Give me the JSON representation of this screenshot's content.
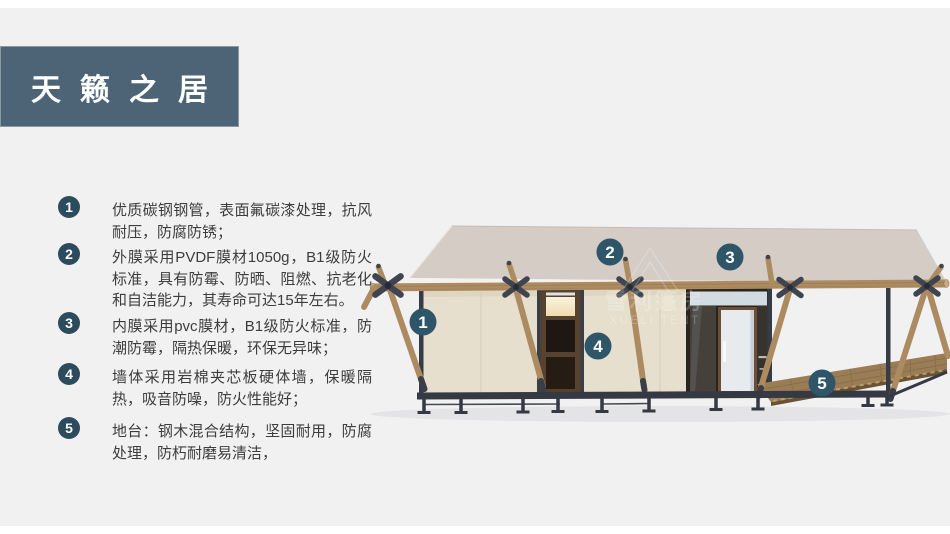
{
  "colors": {
    "page_bg": "#f1f1f2",
    "banner": "#4d6376",
    "badge": "#2c4c5e",
    "callout": "#2e5568",
    "text": "#3d3d3d",
    "roof": "#d5ccc6",
    "wall": "#e7dfcd",
    "wood": "#ad8b61",
    "metal": "#363c45",
    "deck": "#9a7c55"
  },
  "title": {
    "text": "天籁之居"
  },
  "features": [
    {
      "num": "1",
      "text": "优质碳钢钢管，表面氟碳漆处理，抗风耐压，防腐防锈；"
    },
    {
      "num": "2",
      "text": "外膜采用PVDF膜材1050g，B1级防火标准，具有防霉、防晒、阻燃、抗老化和自洁能力，其寿命可达15年左右。"
    },
    {
      "num": "3",
      "text": "内膜采用pvc膜材，B1级防火标准，防潮防霉，隔热保暖，环保无异味；"
    },
    {
      "num": "4",
      "text": "墙体采用岩棉夹芯板硬体墙，保暖隔热，吸音防噪，防火性能好；"
    },
    {
      "num": "5",
      "text": "地台：钢木混合结构，坚固耐用，防腐处理，防朽耐磨易清洁，"
    }
  ],
  "illustration": {
    "callouts": [
      {
        "num": "1"
      },
      {
        "num": "2"
      },
      {
        "num": "3"
      },
      {
        "num": "4"
      },
      {
        "num": "5"
      }
    ],
    "watermark": {
      "cn": "雪利篷房",
      "en": "XUELI TENT"
    }
  }
}
